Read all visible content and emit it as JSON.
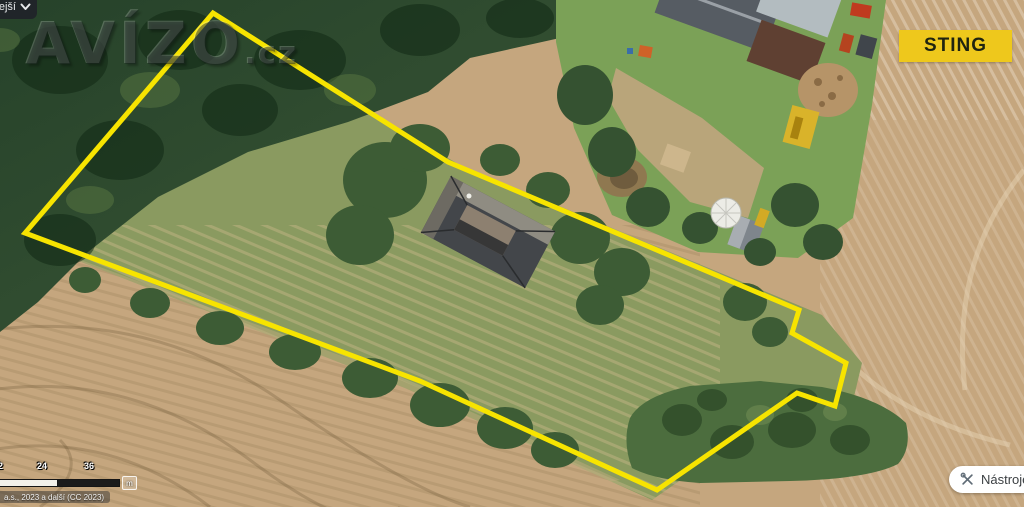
{
  "map": {
    "layer_button": {
      "label": "ejší"
    },
    "watermark": {
      "text": "AVÍZO",
      "suffix": ".cz"
    },
    "sting_badge": {
      "label": "STING"
    },
    "scale_bar": {
      "labels": [
        "12",
        "24",
        "36"
      ],
      "unit": "m"
    },
    "attribution": "a.s., 2023 a další (CC 2023)",
    "tools_button": {
      "label": "Nástroje"
    }
  },
  "scene": {
    "property_outline_points": "213,13 448,162 799,310 792,333 846,363 835,406 797,393 657,490 420,381 25,233"
  },
  "theme": {
    "outline_yellow": "#f7e400",
    "sting_yellow": "#eec81c",
    "sting_text": "#1f2410",
    "field_tan": "#c5a67e",
    "forest_green": "#2c4a2e",
    "meadow_olive": "#8a9a60"
  }
}
